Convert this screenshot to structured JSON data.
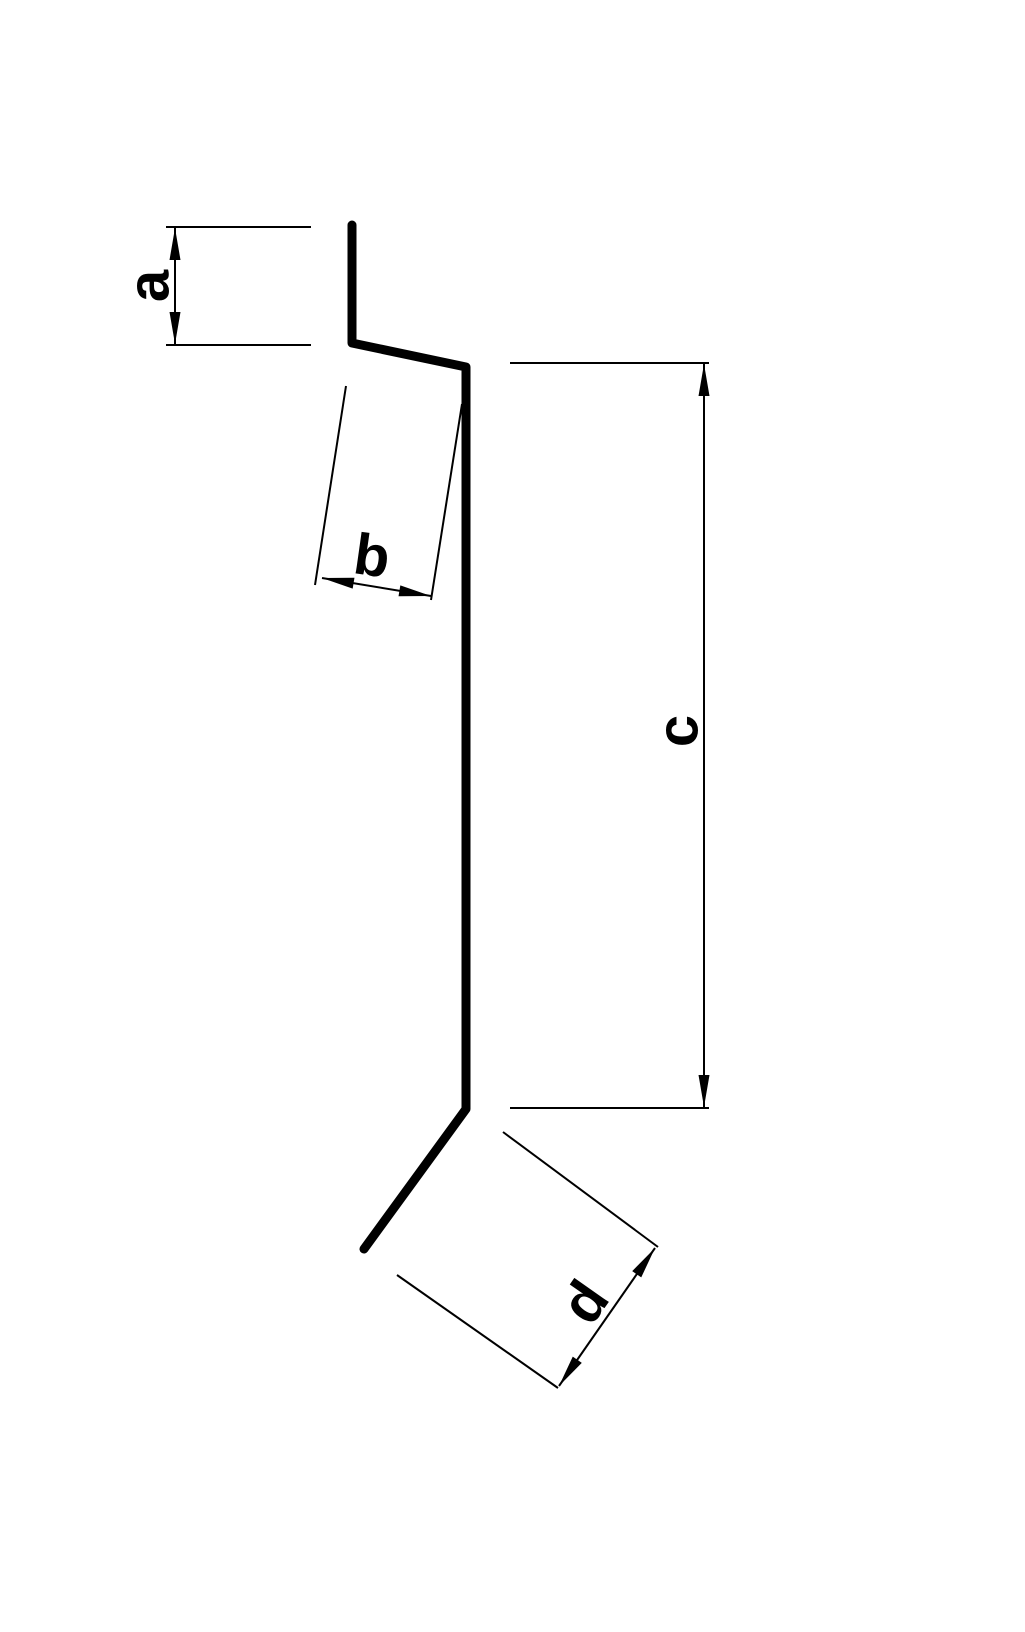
{
  "drawing": {
    "type": "technical-profile-drawing",
    "canvas": {
      "width": 1025,
      "height": 1632
    },
    "style": {
      "background_color": "#ffffff",
      "line_color": "#000000",
      "profile_stroke_width": 9,
      "thin_stroke_width": 2,
      "arrow_length": 32,
      "arrow_half_width": 5.5,
      "label_font_size": 58
    },
    "profile": {
      "description": "sheet-metal flashing profile, thick black bent line",
      "points": [
        [
          352,
          225
        ],
        [
          352,
          343
        ],
        [
          466,
          367
        ],
        [
          466,
          1109
        ],
        [
          364,
          1249
        ]
      ]
    },
    "dimensions": [
      {
        "name": "a",
        "label": "a",
        "extension_lines": [
          [
            166,
            227,
            311,
            227
          ],
          [
            166,
            345,
            311,
            345
          ]
        ],
        "line": [
          175,
          228,
          175,
          344
        ],
        "label_pos": [
          149,
          286
        ],
        "label_rotation": -90
      },
      {
        "name": "b",
        "label": "b",
        "extension_lines": [
          [
            346,
            386,
            315,
            585
          ],
          [
            462,
            404,
            431,
            600
          ]
        ],
        "line": [
          322,
          578,
          431,
          596
        ],
        "label_pos": [
          372,
          556
        ],
        "label_rotation": 8
      },
      {
        "name": "c",
        "label": "c",
        "extension_lines": [
          [
            510,
            363,
            709,
            363
          ],
          [
            510,
            1108,
            709,
            1108
          ]
        ],
        "line": [
          704,
          364,
          704,
          1107
        ],
        "label_pos": [
          678,
          731
        ],
        "label_rotation": -90
      },
      {
        "name": "d",
        "label": "d",
        "extension_lines": [
          [
            503,
            1132,
            658,
            1247
          ],
          [
            397,
            1275,
            558,
            1388
          ]
        ],
        "line": [
          559,
          1386,
          655,
          1248
        ],
        "label_pos": [
          585,
          1302
        ],
        "label_rotation": -55
      }
    ]
  }
}
